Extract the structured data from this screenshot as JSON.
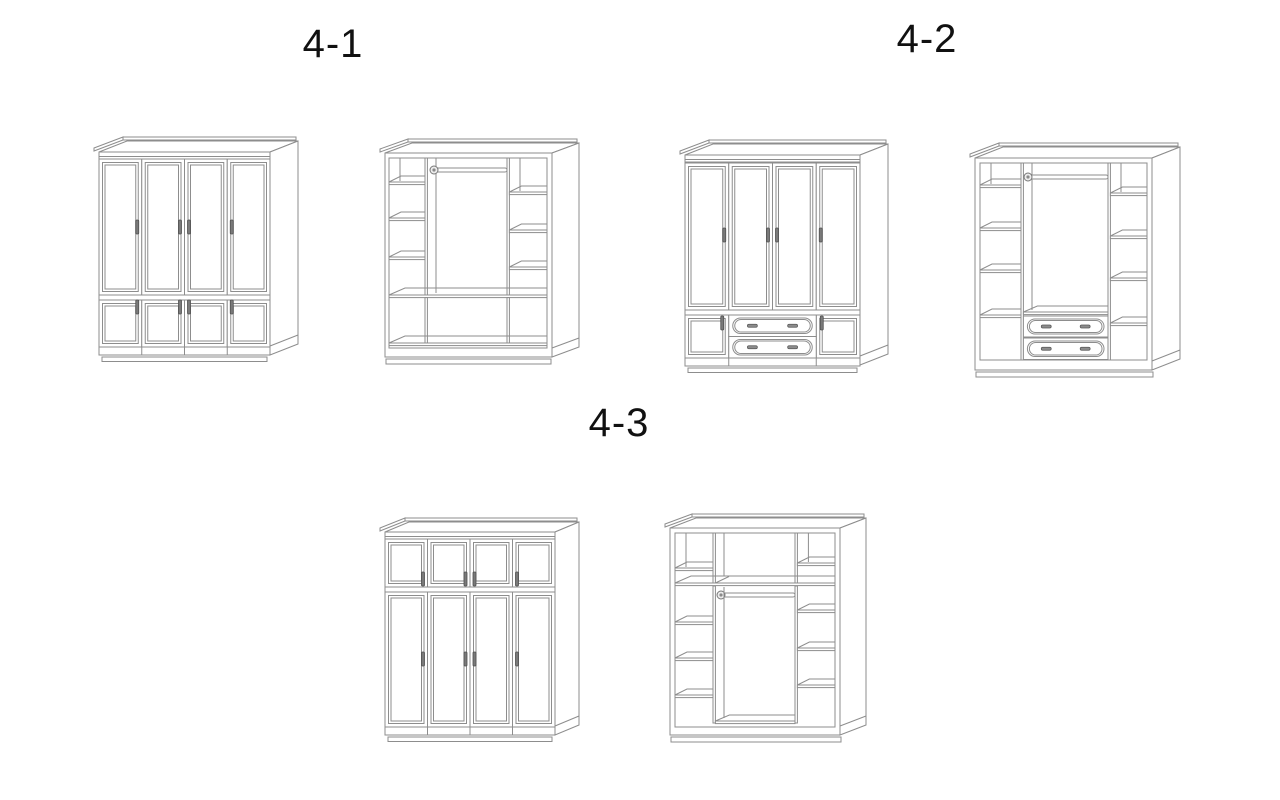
{
  "page": {
    "background": "#ffffff",
    "width": 1280,
    "height": 800
  },
  "style": {
    "line_color": "#8d8d8d",
    "label_color": "#111111"
  },
  "figures": [
    {
      "label": "4-1",
      "views": [
        {
          "icon": "wardrobe-exterior-four-doors-over-four-small-doors"
        },
        {
          "icon": "wardrobe-interior-side-shelves-hanging-rod-full-width-bottom-shelf"
        }
      ]
    },
    {
      "label": "4-2",
      "views": [
        {
          "icon": "wardrobe-exterior-four-doors-over-two-drawers-between-small-doors"
        },
        {
          "icon": "wardrobe-interior-side-shelves-hanging-rod-two-drawers"
        }
      ]
    },
    {
      "label": "4-3",
      "views": [
        {
          "icon": "wardrobe-exterior-four-small-doors-over-four-tall-doors"
        },
        {
          "icon": "wardrobe-interior-top-shelf-hanging-rod-side-shelves"
        }
      ]
    }
  ]
}
